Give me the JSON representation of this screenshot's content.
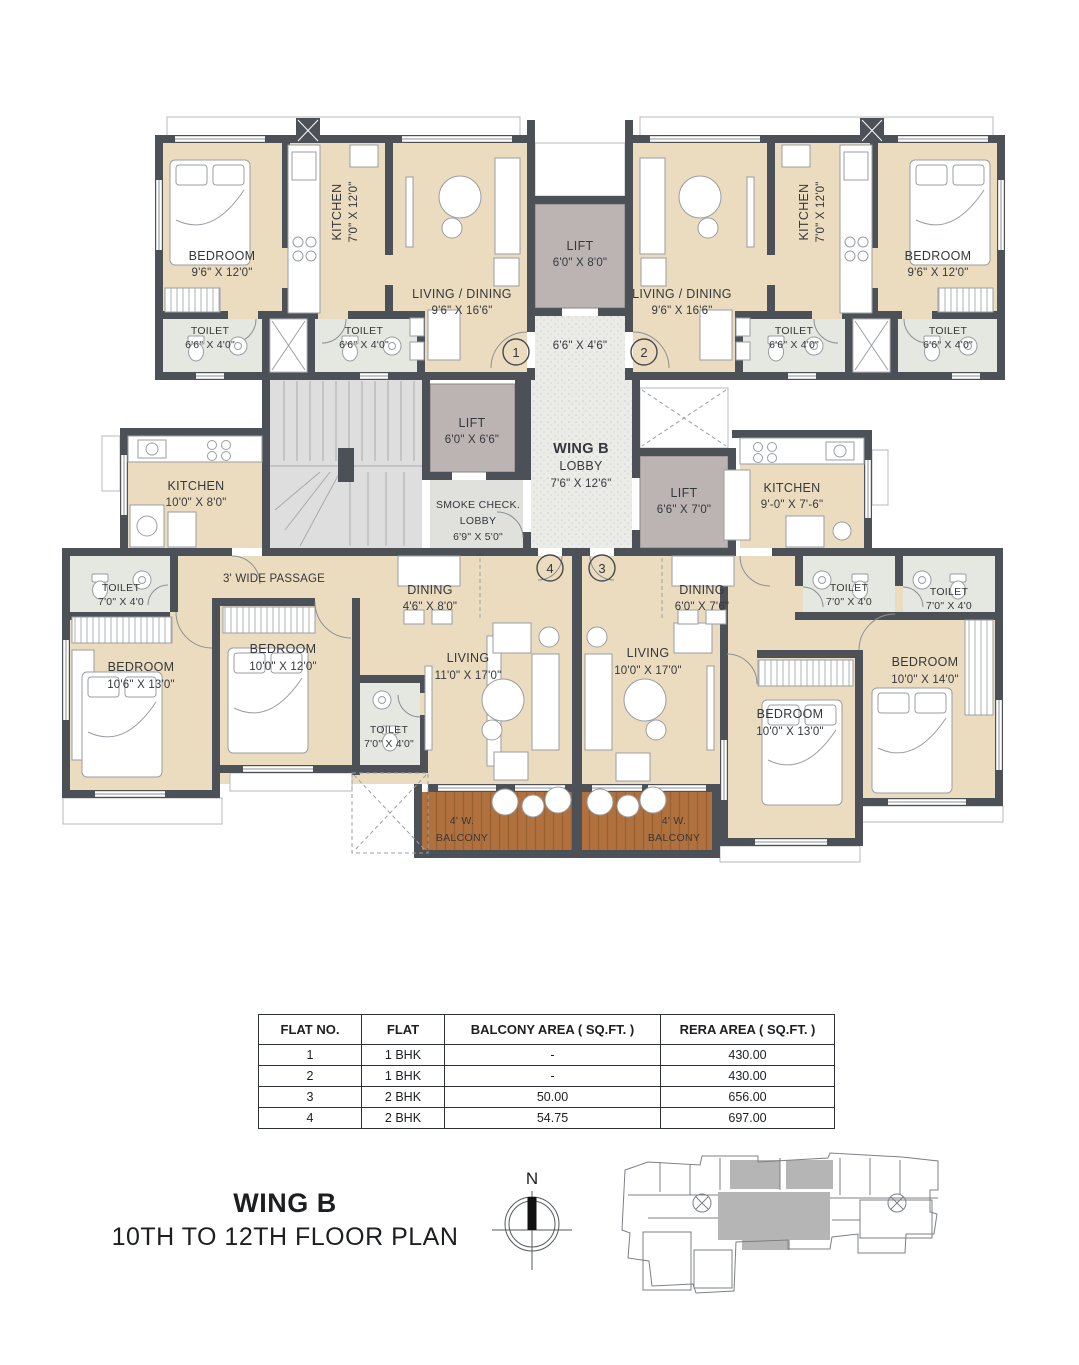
{
  "title": {
    "line1": "WING B",
    "line2": "10TH TO 12TH FLOOR PLAN"
  },
  "compass": {
    "label": "N"
  },
  "markers": {
    "m1": "1",
    "m2": "2",
    "m3": "3",
    "m4": "4"
  },
  "lobby": {
    "title": "WING B",
    "name": "LOBBY",
    "dims": "7'6\" X 12'6\""
  },
  "rooms": {
    "tl_bedroom": {
      "name": "BEDROOM",
      "dims": "9'6\" X 12'0\""
    },
    "tl_kitchen": {
      "name": "KITCHEN",
      "dims": "7'0\" X 12'0\""
    },
    "tl_living": {
      "name": "LIVING / DINING",
      "dims": "9'6\" X 16'6\""
    },
    "tl_toilet1": {
      "name": "TOILET",
      "dims": "6'6\" X 4'0\""
    },
    "tl_toilet2": {
      "name": "TOILET",
      "dims": "6'6\" X 4'0\""
    },
    "tr_bedroom": {
      "name": "BEDROOM",
      "dims": "9'6\" X 12'0\""
    },
    "tr_kitchen": {
      "name": "KITCHEN",
      "dims": "7'0\" X 12'0\""
    },
    "tr_living": {
      "name": "LIVING / DINING",
      "dims": "9'6\" X 16'6\""
    },
    "tr_toilet1": {
      "name": "TOILET",
      "dims": "6'6\" X 4'0\""
    },
    "tr_toilet2": {
      "name": "TOILET",
      "dims": "6'6\" X 4'0\""
    },
    "lift_top": {
      "name": "LIFT",
      "dims": "6'0\" X 8'0\""
    },
    "vestibule": {
      "dims": "6'6\" X 4'6\""
    },
    "lift_mid": {
      "name": "LIFT",
      "dims": "6'0\" X 6'6\""
    },
    "lift_right": {
      "name": "LIFT",
      "dims": "6'6\" X 7'0\""
    },
    "smoke_lobby": {
      "line1": "SMOKE CHECK.",
      "line2": "LOBBY",
      "dims": "6'9\" X 5'0\""
    },
    "ml_kitchen": {
      "name": "KITCHEN",
      "dims": "10'0\" X 8'0\""
    },
    "mr_kitchen": {
      "name": "KITCHEN",
      "dims": "9'-0\" X 7'-6\""
    },
    "passage": {
      "name": "3' WIDE PASSAGE"
    },
    "bl_toilet1": {
      "name": "TOILET",
      "dims": "7'0\" X 4'0"
    },
    "bl_bedroom1": {
      "name": "BEDROOM",
      "dims": "10'6\" X 13'0\""
    },
    "bl_bedroom2": {
      "name": "BEDROOM",
      "dims": "10'0\" X 12'0\""
    },
    "bl_toilet2": {
      "name": "TOILET",
      "dims": "7'0\" X 4'0\""
    },
    "bl_dining": {
      "name": "DINING",
      "dims": "4'6\" X 8'0\""
    },
    "bl_living": {
      "name": "LIVING",
      "dims": "11'0\" X 17'0\""
    },
    "bl_balcony": {
      "line1": "4' W.",
      "line2": "BALCONY"
    },
    "br_dining": {
      "name": "DINING",
      "dims": "6'0\" X 7'6\""
    },
    "br_living": {
      "name": "LIVING",
      "dims": "10'0\" X 17'0\""
    },
    "br_balcony": {
      "line1": "4' W.",
      "line2": "BALCONY"
    },
    "br_toilet1": {
      "name": "TOILET",
      "dims": "7'0\" X 4'0"
    },
    "br_toilet2": {
      "name": "TOILET",
      "dims": "7'0\" X 4'0"
    },
    "br_bedroom1": {
      "name": "BEDROOM",
      "dims": "10'0\" X 13'0\""
    },
    "br_bedroom2": {
      "name": "BEDROOM",
      "dims": "10'0\" X 14'0\""
    }
  },
  "table": {
    "headers": [
      "FLAT NO.",
      "FLAT",
      "BALCONY AREA ( SQ.FT. )",
      "RERA AREA ( SQ.FT. )"
    ],
    "rows": [
      [
        "1",
        "1 BHK",
        "-",
        "430.00"
      ],
      [
        "2",
        "1 BHK",
        "-",
        "430.00"
      ],
      [
        "3",
        "2 BHK",
        "50.00",
        "656.00"
      ],
      [
        "4",
        "2 BHK",
        "54.75",
        "697.00"
      ]
    ]
  },
  "colors": {
    "wall": "#4b5157",
    "floor": "#ecdcbf",
    "toilet_floor": "#e4e8e0",
    "lift": "#bcb3b3",
    "stairs": "#dedede",
    "smoke_lobby": "#e0e1dc",
    "balcony": "#b0713f",
    "keyplan_highlight": "#b5b5b5"
  }
}
